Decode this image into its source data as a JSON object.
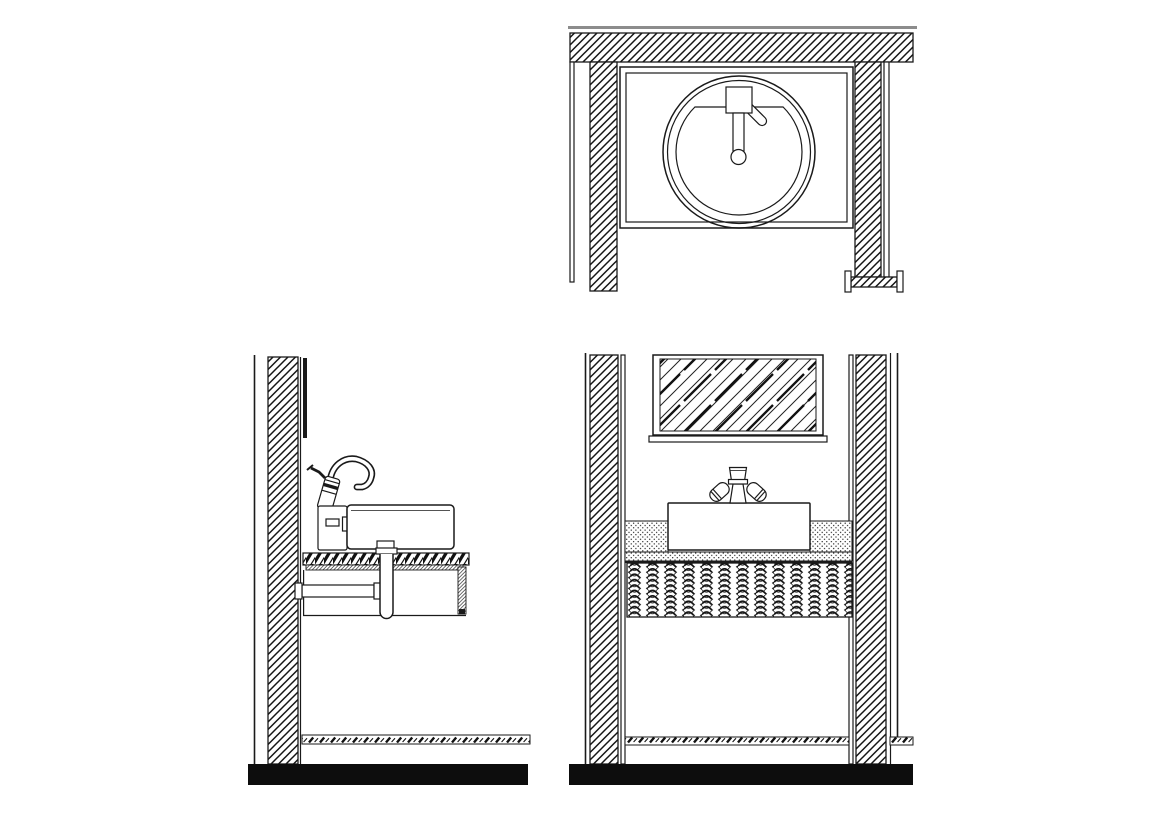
{
  "document": {
    "type": "architectural-line-drawing",
    "subject": "bathroom-vanity-sink-details",
    "text_content": "none"
  },
  "colors": {
    "line": "#1a1a1a",
    "gray_line": "#8c8c8c",
    "floor": "#0d0d0d",
    "paper": "#ffffff"
  },
  "views": [
    {
      "id": "plan-view",
      "name": "sink-plan-view",
      "components": [
        "wall-section-hatch",
        "counter-outline",
        "round-basin-double-rim",
        "faucet-plate",
        "faucet-lever",
        "faucet-spout",
        "drain-circle",
        "pipe-flange-symbol"
      ]
    },
    {
      "id": "side-elevation",
      "name": "vanity-side-elevation",
      "components": [
        "wall-section-hatch",
        "mirror-edge",
        "gooseneck-faucet",
        "faucet-control-box",
        "vessel-sink",
        "countertop-band",
        "towel-bar",
        "drain-p-trap",
        "side-panel",
        "baseboard",
        "floor-slab"
      ]
    },
    {
      "id": "front-elevation",
      "name": "vanity-front-elevation",
      "components": [
        "left-wall-section-hatch",
        "right-wall-section-hatch",
        "framed-mirror-glass",
        "two-handle-faucet",
        "vessel-sink",
        "stipple-backsplash",
        "stipple-countertop",
        "woven-apron-panel",
        "baseboard",
        "floor-slab"
      ]
    }
  ],
  "patterns": {
    "wall_hatch": "diagonal-45deg-lines",
    "mirror_glass": "sparse-diagonal-lines",
    "backsplash": "stipple-dots",
    "apron": "woven-wave-texture",
    "baseboard": "chain-dash-hatch",
    "counter_edge": "dense-diagonal-blocks"
  }
}
